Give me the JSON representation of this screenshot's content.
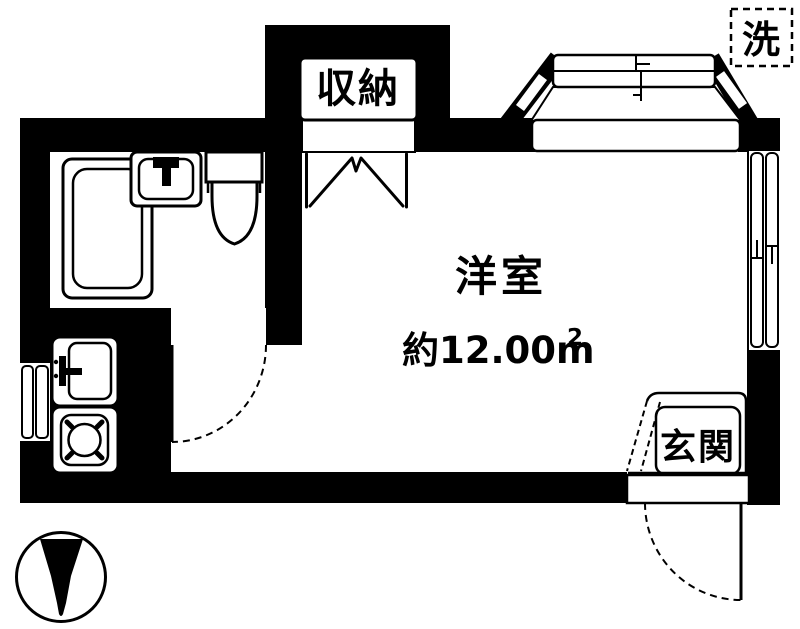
{
  "colors": {
    "line": "#000000",
    "background": "#ffffff"
  },
  "labels": {
    "closet": "収納",
    "laundry": "洗",
    "room": "洋室",
    "area": "約12.00m",
    "area_superscript": "2",
    "entrance": "玄関"
  },
  "fixtures": [
    "bathtub",
    "washbasin",
    "toilet",
    "kitchen-sink",
    "gas-stove",
    "bay-window",
    "folding-closet-door",
    "sliding-window",
    "hinged-door",
    "north-arrow"
  ],
  "icons": {
    "north_arrow": "north-arrow-down"
  }
}
